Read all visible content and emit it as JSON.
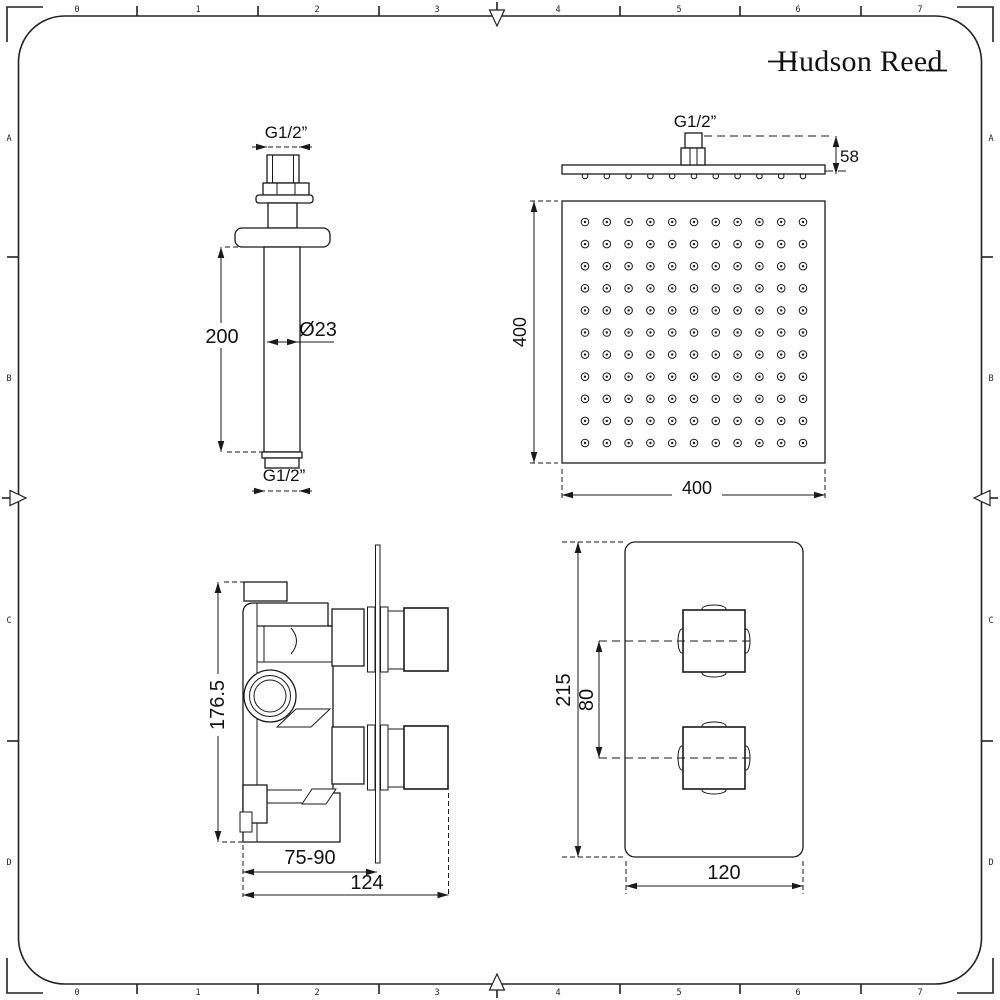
{
  "brand": {
    "name": "Hudson Reed"
  },
  "ruler": {
    "numbers": [
      "0",
      "1",
      "2",
      "3",
      "4",
      "5",
      "6",
      "7"
    ],
    "letters": [
      "A",
      "B",
      "C",
      "D"
    ]
  },
  "drawings": {
    "ceiling_arm": {
      "top_thread_label": "G1/2”",
      "length_label": "200",
      "diameter_label": "Ø23",
      "bottom_thread_label": "G1/2”"
    },
    "head_side": {
      "thread_label": "G1/2”",
      "height_label": "58"
    },
    "head_face": {
      "width_label": "400",
      "height_label": "400",
      "nozzles": {
        "rows": 11,
        "cols": 11,
        "x0": 585,
        "y0": 222,
        "dx": 21.8,
        "dy": 22.1,
        "r_outer": 3.8,
        "r_dot": 1.2,
        "side_y": 176,
        "side_r": 2.8
      }
    },
    "valve_side": {
      "height_label": "176.5",
      "depth_min_max_label": "75-90",
      "depth_total_label": "124"
    },
    "valve_front": {
      "height_label": "215",
      "spacing_label": "80",
      "width_label": "120"
    }
  }
}
